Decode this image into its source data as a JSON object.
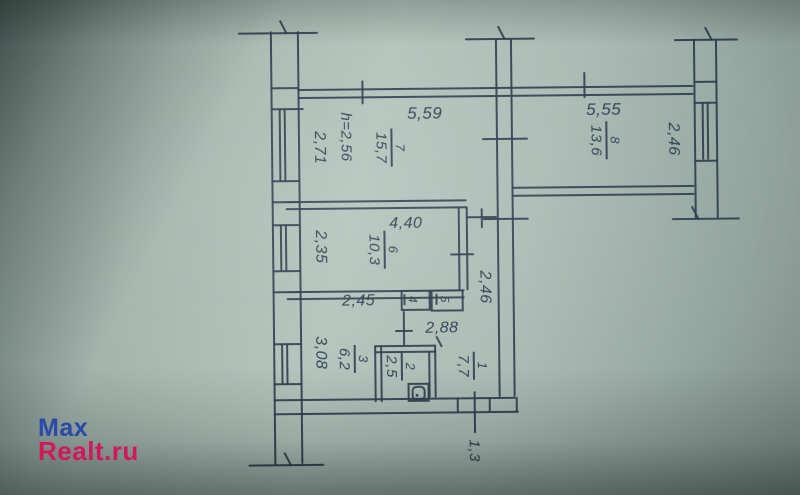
{
  "watermark": {
    "line1": "Max",
    "line2": "Realt.ru",
    "blue": "#2b49a8",
    "pink": "#d3175f"
  },
  "rooms": {
    "r1": {
      "number": "1",
      "area": "7,7"
    },
    "r2": {
      "number": "2",
      "area": "2,5"
    },
    "r3": {
      "number": "3",
      "area": "6,2"
    },
    "r4": {
      "number": "4"
    },
    "r5": {
      "number": "5"
    },
    "r6": {
      "number": "6",
      "area": "10,3"
    },
    "r7": {
      "number": "7",
      "area": "15,7"
    },
    "r8": {
      "number": "8",
      "area": "13,6"
    }
  },
  "dimensions": {
    "room7_width": "5,59",
    "room7_depth": "2,71",
    "ceiling_height": "h=2,56",
    "room8_width": "5,55",
    "room8_depth": "2,46",
    "room6_width": "4,40",
    "room6_depth": "2,35",
    "room3_width": "2,45",
    "room3_depth": "3,08",
    "hall_width": "2,88",
    "corridor_length": "2,46",
    "entry_width": "1,3"
  },
  "colors": {
    "ink": "#2d4052",
    "paper": "#aabbb4"
  }
}
